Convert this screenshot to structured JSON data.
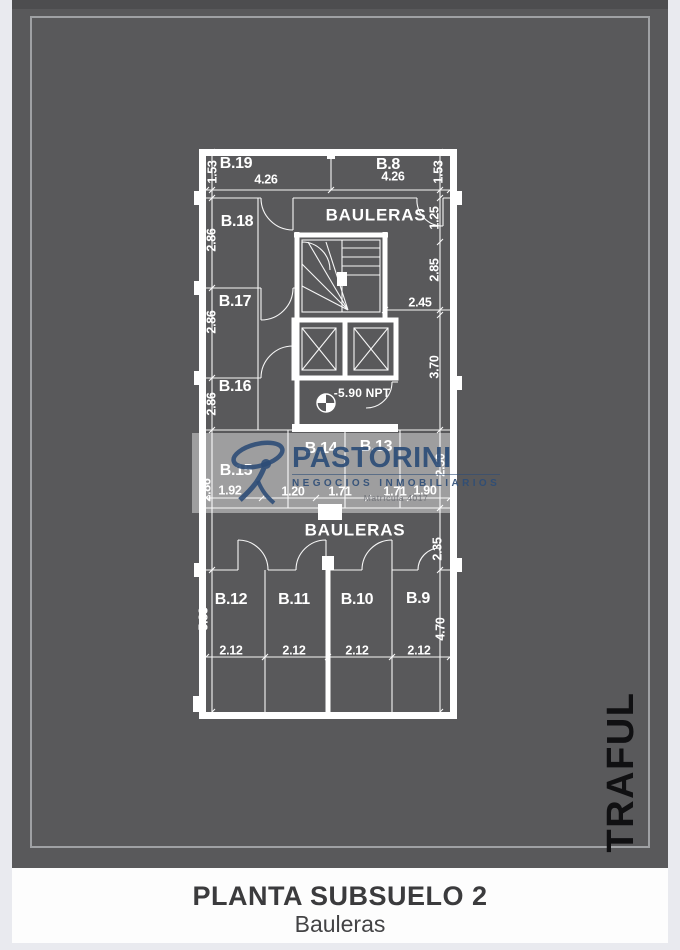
{
  "poster": {
    "background": "#59595b",
    "side_label": "TRAFUL"
  },
  "watermark": {
    "brand": "PASTORINI",
    "tagline": "NEGOCIOS INMOBILIARIOS",
    "license": "Matrícula 4017",
    "color": "#2d4d77"
  },
  "footer": {
    "title": "PLANTA SUBSUELO 2",
    "subtitle": "Bauleras"
  },
  "plan": {
    "level_note": "-5.90 NPT",
    "texts": [
      {
        "t": "B.19",
        "x": 58,
        "y": 34,
        "k": "room"
      },
      {
        "t": "B.8",
        "x": 210,
        "y": 35,
        "k": "room"
      },
      {
        "t": "B.18",
        "x": 59,
        "y": 92,
        "k": "room"
      },
      {
        "t": "B.17",
        "x": 57,
        "y": 172,
        "k": "room"
      },
      {
        "t": "B.16",
        "x": 57,
        "y": 257,
        "k": "room"
      },
      {
        "t": "B.15",
        "x": 58,
        "y": 341,
        "k": "room"
      },
      {
        "t": "B.14",
        "x": 143,
        "y": 319,
        "k": "room"
      },
      {
        "t": "B.13",
        "x": 198,
        "y": 317,
        "k": "room"
      },
      {
        "t": "B.12",
        "x": 53,
        "y": 470,
        "k": "room"
      },
      {
        "t": "B.11",
        "x": 116,
        "y": 470,
        "k": "room"
      },
      {
        "t": "B.10",
        "x": 179,
        "y": 470,
        "k": "room"
      },
      {
        "t": "B.9",
        "x": 240,
        "y": 469,
        "k": "room"
      },
      {
        "t": "BAULERAS",
        "x": 198,
        "y": 86,
        "k": "area"
      },
      {
        "t": "BAULERAS",
        "x": 177,
        "y": 401,
        "k": "area"
      },
      {
        "t": "4.26",
        "x": 88,
        "y": 50,
        "k": "dim"
      },
      {
        "t": "4.26",
        "x": 215,
        "y": 47,
        "k": "dim"
      },
      {
        "t": "2.45",
        "x": 242,
        "y": 173,
        "k": "dim"
      },
      {
        "t": "1.92",
        "x": 52,
        "y": 361,
        "k": "dim"
      },
      {
        "t": "1.20",
        "x": 115,
        "y": 362,
        "k": "dim"
      },
      {
        "t": "1.71",
        "x": 162,
        "y": 362,
        "k": "dim"
      },
      {
        "t": "1.71",
        "x": 217,
        "y": 362,
        "k": "dim"
      },
      {
        "t": "1.90",
        "x": 247,
        "y": 361,
        "k": "dim"
      },
      {
        "t": "2.12",
        "x": 53,
        "y": 521,
        "k": "dim"
      },
      {
        "t": "2.12",
        "x": 116,
        "y": 521,
        "k": "dim"
      },
      {
        "t": "2.12",
        "x": 179,
        "y": 521,
        "k": "dim"
      },
      {
        "t": "2.12",
        "x": 241,
        "y": 521,
        "k": "dim"
      },
      {
        "t": "-5.90 NPT",
        "x": 184,
        "y": 264,
        "k": "npt"
      },
      {
        "t": "1.53",
        "x": 35,
        "y": 42,
        "k": "dim",
        "rot": true
      },
      {
        "t": "2.86",
        "x": 34,
        "y": 110,
        "k": "dim",
        "rot": true
      },
      {
        "t": "2.86",
        "x": 34,
        "y": 192,
        "k": "dim",
        "rot": true
      },
      {
        "t": "2.86",
        "x": 34,
        "y": 274,
        "k": "dim",
        "rot": true
      },
      {
        "t": "2.86",
        "x": 29,
        "y": 360,
        "k": "dim",
        "rot": true
      },
      {
        "t": "5.83",
        "x": 26,
        "y": 489,
        "k": "dim",
        "rot": true
      },
      {
        "t": "1.53",
        "x": 261,
        "y": 42,
        "k": "dim",
        "rot": true
      },
      {
        "t": "1.25",
        "x": 257,
        "y": 88,
        "k": "dim",
        "rot": true
      },
      {
        "t": "2.85",
        "x": 257,
        "y": 140,
        "k": "dim",
        "rot": true
      },
      {
        "t": "3.70",
        "x": 257,
        "y": 237,
        "k": "dim",
        "rot": true
      },
      {
        "t": "2.50",
        "x": 263,
        "y": 335,
        "k": "dim",
        "rot": true
      },
      {
        "t": "2.35",
        "x": 260,
        "y": 419,
        "k": "dim",
        "rot": true
      },
      {
        "t": "4.70",
        "x": 263,
        "y": 499,
        "k": "dim",
        "rot": true
      }
    ]
  }
}
